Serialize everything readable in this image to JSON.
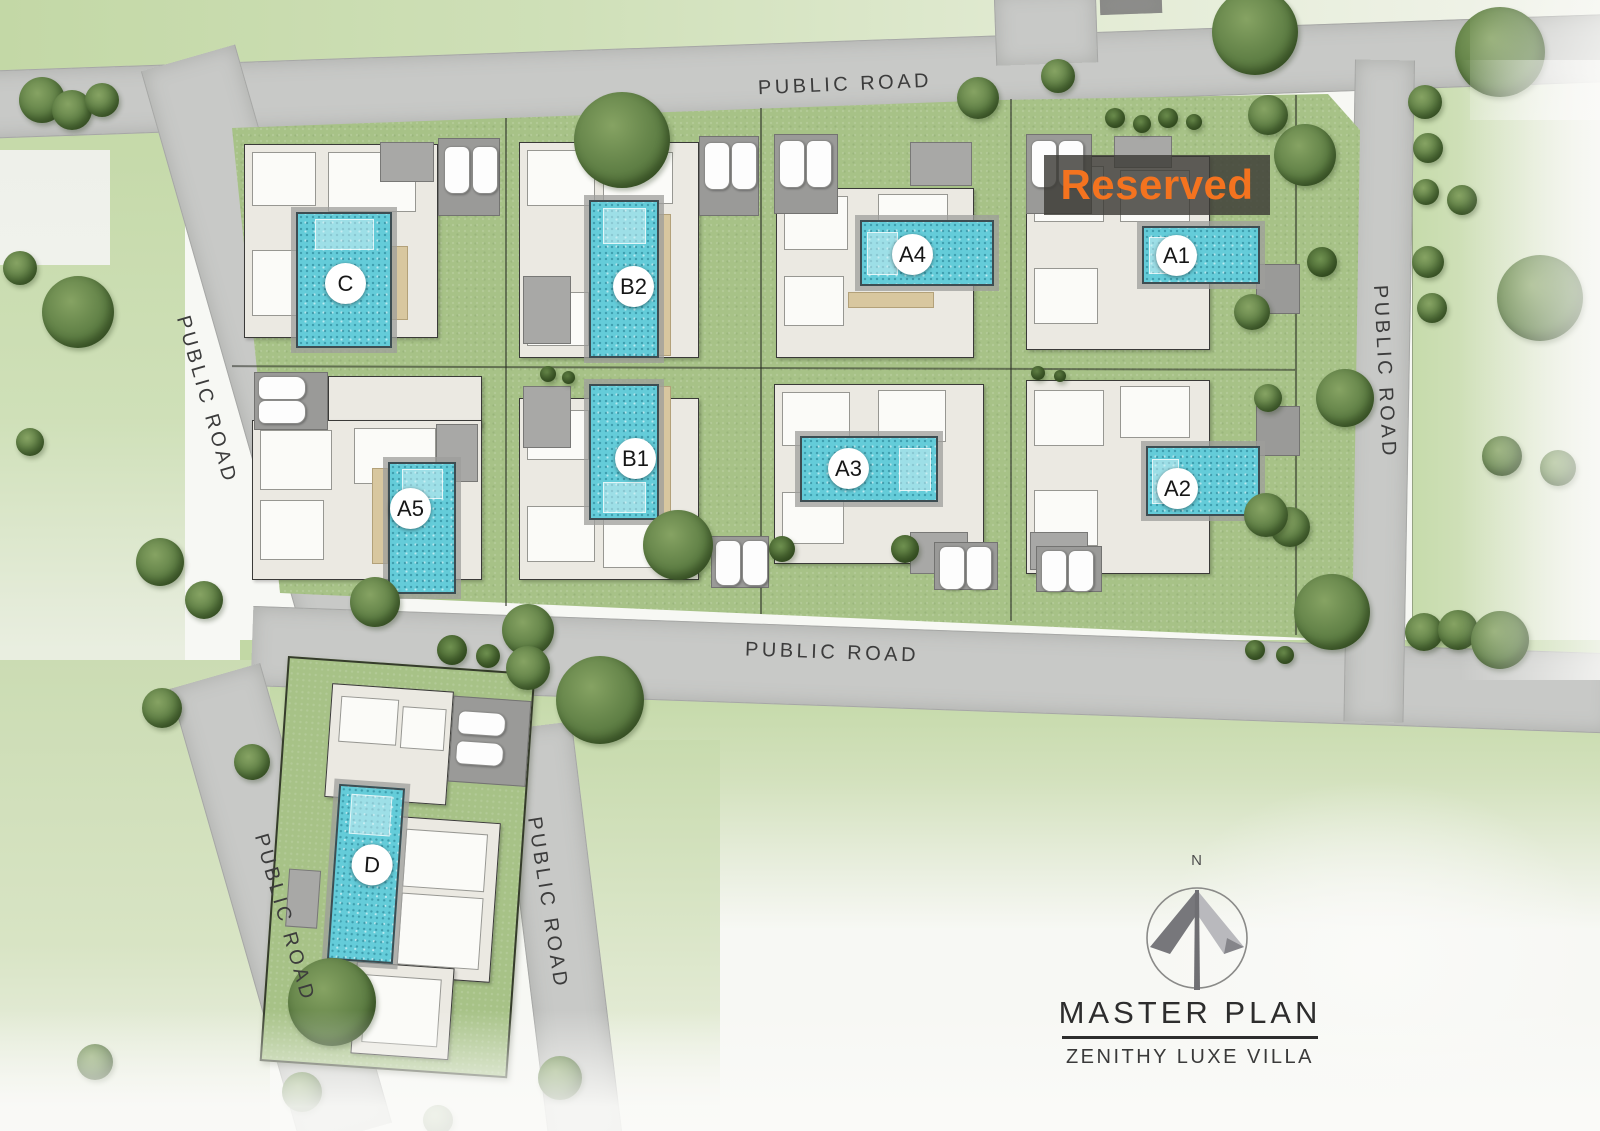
{
  "title": {
    "heading": "MASTER PLAN",
    "subtitle": "ZENITHY LUXE VILLA"
  },
  "compass": {
    "north_label": "N"
  },
  "reserved": {
    "label": "Reserved",
    "text_color": "#f4731f",
    "applies_to_villa": "A1"
  },
  "colors": {
    "road": "#c8c9c7",
    "lawn": "#cfe0b8",
    "compound_green": "#a7c287",
    "pool_water": "#64ccd9",
    "reserved_bg": "rgba(60,58,54,0.82)"
  },
  "roads": [
    {
      "id": "top",
      "label": "PUBLIC ROAD",
      "geom": {
        "x": -40,
        "y": 42,
        "w": 1700,
        "h": 66,
        "rot": -2,
        "org": "50% 50%",
        "cls": "hr"
      },
      "label_pos": {
        "x": 845,
        "y": 85,
        "rot": -2.5
      }
    },
    {
      "id": "top-stub",
      "label": null,
      "geom": {
        "x": 995,
        "y": -8,
        "w": 100,
        "h": 72,
        "rot": -2,
        "org": "50% 50%",
        "cls": "vr"
      },
      "label_pos": null
    },
    {
      "id": "left",
      "label": "PUBLIC ROAD",
      "geom": {
        "x": 139,
        "y": 58,
        "w": 96,
        "h": 600,
        "rot": -16,
        "org": "50% 0",
        "cls": "vr"
      },
      "label_pos": {
        "x": 206,
        "y": 400,
        "rot": 74
      }
    },
    {
      "id": "middle",
      "label": "PUBLIC ROAD",
      "geom": {
        "x": 252,
        "y": 606,
        "w": 1360,
        "h": 78,
        "rot": 2,
        "org": "0 50%",
        "cls": "hr"
      },
      "label_pos": {
        "x": 832,
        "y": 653,
        "rot": 2
      }
    },
    {
      "id": "right",
      "label": "PUBLIC ROAD",
      "geom": {
        "x": 1355,
        "y": 60,
        "w": 58,
        "h": 662,
        "rot": 1,
        "org": "50% 0",
        "cls": "vr"
      },
      "label_pos": {
        "x": 1384,
        "y": 372,
        "rot": 87
      }
    },
    {
      "id": "d-left",
      "label": "PUBLIC ROAD",
      "geom": {
        "x": 168,
        "y": 676,
        "w": 92,
        "h": 478,
        "rot": -16,
        "org": "50% 0",
        "cls": "vr"
      },
      "label_pos": {
        "x": 284,
        "y": 918,
        "rot": 74
      }
    },
    {
      "id": "d-right",
      "label": "PUBLIC ROAD",
      "geom": {
        "x": 498,
        "y": 726,
        "w": 72,
        "h": 420,
        "rot": -7,
        "org": "50% 0",
        "cls": "vr"
      },
      "label_pos": {
        "x": 547,
        "y": 903,
        "rot": 81
      }
    }
  ],
  "villas": [
    {
      "id": "C",
      "label": "C",
      "plot": {
        "x": 232,
        "y": 128,
        "w": 273,
        "h": 232,
        "rot": 0
      },
      "parts": [
        {
          "t": "bld",
          "x": 12,
          "y": 16,
          "w": 192,
          "h": 192
        },
        {
          "t": "room",
          "x": 20,
          "y": 24,
          "w": 62,
          "h": 52
        },
        {
          "t": "room",
          "x": 96,
          "y": 24,
          "w": 86,
          "h": 58
        },
        {
          "t": "room",
          "x": 20,
          "y": 122,
          "w": 58,
          "h": 64
        },
        {
          "t": "roof",
          "x": 148,
          "y": 14,
          "w": 52,
          "h": 38
        },
        {
          "t": "deck",
          "x": 158,
          "y": 118,
          "w": 16,
          "h": 72
        },
        {
          "t": "pad",
          "x": 206,
          "y": 10,
          "w": 60,
          "h": 76
        }
      ],
      "pool": {
        "x": 64,
        "y": 84,
        "w": 92,
        "h": 132,
        "step": "top"
      },
      "cars": [
        {
          "x": 212,
          "y": 18,
          "o": "v"
        },
        {
          "x": 240,
          "y": 18,
          "o": "v"
        }
      ],
      "label_pos": {
        "x": 113,
        "y": 155
      }
    },
    {
      "id": "A5",
      "label": "A5",
      "plot": {
        "x": 232,
        "y": 360,
        "w": 273,
        "h": 232,
        "rot": 0
      },
      "parts": [
        {
          "t": "bld",
          "x": 96,
          "y": 16,
          "w": 152,
          "h": 50
        },
        {
          "t": "bld",
          "x": 20,
          "y": 60,
          "w": 228,
          "h": 158
        },
        {
          "t": "room",
          "x": 28,
          "y": 70,
          "w": 70,
          "h": 58
        },
        {
          "t": "room",
          "x": 122,
          "y": 68,
          "w": 80,
          "h": 54
        },
        {
          "t": "room",
          "x": 28,
          "y": 140,
          "w": 62,
          "h": 58
        },
        {
          "t": "roof",
          "x": 204,
          "y": 64,
          "w": 40,
          "h": 56
        },
        {
          "t": "deck",
          "x": 140,
          "y": 108,
          "w": 14,
          "h": 94
        },
        {
          "t": "pad",
          "x": 22,
          "y": 12,
          "w": 72,
          "h": 56
        }
      ],
      "pool": {
        "x": 156,
        "y": 102,
        "w": 64,
        "h": 128,
        "step": "top"
      },
      "cars": [
        {
          "x": 26,
          "y": 16,
          "o": "h"
        },
        {
          "x": 26,
          "y": 40,
          "o": "h"
        }
      ],
      "label_pos": {
        "x": 178,
        "y": 148
      }
    },
    {
      "id": "B2",
      "label": "B2",
      "plot": {
        "x": 505,
        "y": 128,
        "w": 255,
        "h": 242,
        "rot": 0
      },
      "parts": [
        {
          "t": "bld",
          "x": 14,
          "y": 14,
          "w": 178,
          "h": 214
        },
        {
          "t": "room",
          "x": 22,
          "y": 22,
          "w": 66,
          "h": 54
        },
        {
          "t": "room",
          "x": 98,
          "y": 24,
          "w": 68,
          "h": 50
        },
        {
          "t": "room",
          "x": 22,
          "y": 164,
          "w": 60,
          "h": 52
        },
        {
          "t": "roof",
          "x": 18,
          "y": 148,
          "w": 46,
          "h": 66
        },
        {
          "t": "deck",
          "x": 152,
          "y": 86,
          "w": 12,
          "h": 140
        },
        {
          "t": "pad",
          "x": 194,
          "y": 8,
          "w": 58,
          "h": 78
        }
      ],
      "pool": {
        "x": 84,
        "y": 72,
        "w": 66,
        "h": 154,
        "step": "top"
      },
      "cars": [
        {
          "x": 199,
          "y": 14,
          "o": "v"
        },
        {
          "x": 226,
          "y": 14,
          "o": "v"
        }
      ],
      "label_pos": {
        "x": 128,
        "y": 158
      }
    },
    {
      "id": "B1",
      "label": "B1",
      "plot": {
        "x": 505,
        "y": 370,
        "w": 255,
        "h": 222,
        "rot": 0
      },
      "parts": [
        {
          "t": "bld",
          "x": 14,
          "y": 28,
          "w": 178,
          "h": 180
        },
        {
          "t": "room",
          "x": 22,
          "y": 136,
          "w": 66,
          "h": 54
        },
        {
          "t": "room",
          "x": 98,
          "y": 146,
          "w": 68,
          "h": 50
        },
        {
          "t": "room",
          "x": 22,
          "y": 40,
          "w": 60,
          "h": 48
        },
        {
          "t": "roof",
          "x": 18,
          "y": 16,
          "w": 46,
          "h": 60
        },
        {
          "t": "deck",
          "x": 152,
          "y": 16,
          "w": 12,
          "h": 130
        },
        {
          "t": "pad",
          "x": 206,
          "y": 166,
          "w": 56,
          "h": 50
        }
      ],
      "pool": {
        "x": 84,
        "y": 14,
        "w": 66,
        "h": 132,
        "step": "bottom"
      },
      "cars": [
        {
          "x": 210,
          "y": 170,
          "o": "v",
          "len": 44
        },
        {
          "x": 237,
          "y": 170,
          "o": "v",
          "len": 44
        }
      ],
      "label_pos": {
        "x": 130,
        "y": 88
      }
    },
    {
      "id": "A4",
      "label": "A4",
      "plot": {
        "x": 760,
        "y": 128,
        "w": 250,
        "h": 244,
        "rot": 0
      },
      "parts": [
        {
          "t": "bld",
          "x": 16,
          "y": 60,
          "w": 196,
          "h": 168
        },
        {
          "t": "room",
          "x": 24,
          "y": 68,
          "w": 62,
          "h": 52
        },
        {
          "t": "room",
          "x": 118,
          "y": 66,
          "w": 68,
          "h": 54
        },
        {
          "t": "room",
          "x": 24,
          "y": 148,
          "w": 58,
          "h": 48
        },
        {
          "t": "roof",
          "x": 150,
          "y": 14,
          "w": 60,
          "h": 42
        },
        {
          "t": "deck",
          "x": 88,
          "y": 164,
          "w": 84,
          "h": 14
        },
        {
          "t": "pad",
          "x": 14,
          "y": 6,
          "w": 62,
          "h": 78
        }
      ],
      "pool": {
        "x": 100,
        "y": 92,
        "w": 130,
        "h": 62,
        "step": "left"
      },
      "cars": [
        {
          "x": 19,
          "y": 12,
          "o": "v"
        },
        {
          "x": 46,
          "y": 12,
          "o": "v"
        }
      ],
      "label_pos": {
        "x": 152,
        "y": 126
      }
    },
    {
      "id": "A3",
      "label": "A3",
      "plot": {
        "x": 760,
        "y": 372,
        "w": 250,
        "h": 220,
        "rot": 0
      },
      "parts": [
        {
          "t": "bld",
          "x": 14,
          "y": 12,
          "w": 208,
          "h": 178
        },
        {
          "t": "room",
          "x": 22,
          "y": 20,
          "w": 66,
          "h": 52
        },
        {
          "t": "room",
          "x": 118,
          "y": 18,
          "w": 66,
          "h": 50
        },
        {
          "t": "room",
          "x": 22,
          "y": 120,
          "w": 60,
          "h": 50
        },
        {
          "t": "roof",
          "x": 150,
          "y": 160,
          "w": 56,
          "h": 40
        },
        {
          "t": "pad",
          "x": 174,
          "y": 170,
          "w": 62,
          "h": 46
        }
      ],
      "pool": {
        "x": 40,
        "y": 64,
        "w": 134,
        "h": 62,
        "step": "right"
      },
      "cars": [
        {
          "x": 179,
          "y": 174,
          "o": "v",
          "len": 42
        },
        {
          "x": 206,
          "y": 174,
          "o": "v",
          "len": 42
        }
      ],
      "label_pos": {
        "x": 88,
        "y": 96
      }
    },
    {
      "id": "A1",
      "label": "A1",
      "plot": {
        "x": 1010,
        "y": 128,
        "w": 285,
        "h": 244,
        "rot": 0
      },
      "parts": [
        {
          "t": "bld",
          "x": 16,
          "y": 28,
          "w": 182,
          "h": 192
        },
        {
          "t": "room",
          "x": 24,
          "y": 38,
          "w": 68,
          "h": 54
        },
        {
          "t": "room",
          "x": 110,
          "y": 42,
          "w": 68,
          "h": 50
        },
        {
          "t": "room",
          "x": 24,
          "y": 140,
          "w": 62,
          "h": 54
        },
        {
          "t": "roof",
          "x": 104,
          "y": 8,
          "w": 56,
          "h": 30
        },
        {
          "t": "pad",
          "x": 16,
          "y": 6,
          "w": 64,
          "h": 78
        },
        {
          "t": "pad",
          "x": 246,
          "y": 136,
          "w": 42,
          "h": 48
        }
      ],
      "pool": {
        "x": 132,
        "y": 98,
        "w": 114,
        "h": 54,
        "step": "left"
      },
      "cars": [
        {
          "x": 21,
          "y": 12,
          "o": "v"
        },
        {
          "x": 48,
          "y": 12,
          "o": "v"
        }
      ],
      "label_pos": {
        "x": 166,
        "y": 127
      }
    },
    {
      "id": "A2",
      "label": "A2",
      "plot": {
        "x": 1010,
        "y": 372,
        "w": 285,
        "h": 220,
        "rot": 0
      },
      "parts": [
        {
          "t": "bld",
          "x": 16,
          "y": 8,
          "w": 182,
          "h": 192
        },
        {
          "t": "room",
          "x": 24,
          "y": 18,
          "w": 68,
          "h": 54
        },
        {
          "t": "room",
          "x": 110,
          "y": 14,
          "w": 68,
          "h": 50
        },
        {
          "t": "room",
          "x": 24,
          "y": 118,
          "w": 62,
          "h": 54
        },
        {
          "t": "roof",
          "x": 20,
          "y": 160,
          "w": 56,
          "h": 36
        },
        {
          "t": "pad",
          "x": 26,
          "y": 174,
          "w": 64,
          "h": 44
        },
        {
          "t": "pad",
          "x": 246,
          "y": 34,
          "w": 42,
          "h": 48
        }
      ],
      "pool": {
        "x": 136,
        "y": 74,
        "w": 110,
        "h": 66,
        "step": "left"
      },
      "cars": [
        {
          "x": 31,
          "y": 178,
          "o": "v",
          "len": 40
        },
        {
          "x": 58,
          "y": 178,
          "o": "v",
          "len": 40
        }
      ],
      "label_pos": {
        "x": 167,
        "y": 116
      }
    },
    {
      "id": "D",
      "label": "D",
      "plot": {
        "x": 288,
        "y": 656,
        "w": 244,
        "h": 402,
        "rot": 4,
        "standalone": true
      },
      "parts": [
        {
          "t": "bld",
          "x": 44,
          "y": 22,
          "w": 120,
          "h": 112
        },
        {
          "t": "room",
          "x": 54,
          "y": 34,
          "w": 56,
          "h": 44
        },
        {
          "t": "room",
          "x": 116,
          "y": 40,
          "w": 42,
          "h": 40
        },
        {
          "t": "pad",
          "x": 166,
          "y": 26,
          "w": 76,
          "h": 84
        },
        {
          "t": "bld",
          "x": 118,
          "y": 150,
          "w": 102,
          "h": 158
        },
        {
          "t": "room",
          "x": 128,
          "y": 162,
          "w": 80,
          "h": 56
        },
        {
          "t": "room",
          "x": 128,
          "y": 226,
          "w": 80,
          "h": 70
        },
        {
          "t": "bld",
          "x": 88,
          "y": 298,
          "w": 96,
          "h": 90
        },
        {
          "t": "room",
          "x": 98,
          "y": 310,
          "w": 74,
          "h": 66
        },
        {
          "t": "roof",
          "x": 14,
          "y": 210,
          "w": 30,
          "h": 56
        },
        {
          "t": "deck",
          "x": 40,
          "y": 328,
          "w": 60,
          "h": 16
        }
      ],
      "pool": {
        "x": 58,
        "y": 122,
        "w": 62,
        "h": 172,
        "step": "top"
      },
      "cars": [
        {
          "x": 172,
          "y": 40,
          "o": "h"
        },
        {
          "x": 172,
          "y": 70,
          "o": "h"
        }
      ],
      "label_pos": {
        "x": 96,
        "y": 200
      }
    },
    {
      "id": "right-lawn",
      "label": null,
      "plot": {
        "x": 1295,
        "y": 96,
        "w": 60,
        "h": 540,
        "rot": 0
      },
      "parts": [],
      "pool": null,
      "cars": [],
      "label_pos": null
    }
  ],
  "trees": [
    {
      "x": 622,
      "y": 140,
      "d": 96
    },
    {
      "x": 978,
      "y": 98,
      "d": 42
    },
    {
      "x": 1058,
      "y": 76,
      "d": 34
    },
    {
      "x": 1255,
      "y": 32,
      "d": 86
    },
    {
      "x": 1115,
      "y": 118,
      "d": 20,
      "p": 1
    },
    {
      "x": 1142,
      "y": 124,
      "d": 18,
      "p": 1
    },
    {
      "x": 1168,
      "y": 118,
      "d": 20,
      "p": 1
    },
    {
      "x": 1194,
      "y": 122,
      "d": 16,
      "p": 1
    },
    {
      "x": 42,
      "y": 100,
      "d": 46
    },
    {
      "x": 72,
      "y": 110,
      "d": 40
    },
    {
      "x": 102,
      "y": 100,
      "d": 34
    },
    {
      "x": 78,
      "y": 312,
      "d": 72
    },
    {
      "x": 20,
      "y": 268,
      "d": 34
    },
    {
      "x": 30,
      "y": 442,
      "d": 28
    },
    {
      "x": 160,
      "y": 562,
      "d": 48
    },
    {
      "x": 204,
      "y": 600,
      "d": 38
    },
    {
      "x": 1500,
      "y": 52,
      "d": 90
    },
    {
      "x": 1540,
      "y": 298,
      "d": 86
    },
    {
      "x": 1425,
      "y": 102,
      "d": 34
    },
    {
      "x": 1428,
      "y": 148,
      "d": 30
    },
    {
      "x": 1426,
      "y": 192,
      "d": 26
    },
    {
      "x": 1462,
      "y": 200,
      "d": 30
    },
    {
      "x": 1428,
      "y": 262,
      "d": 32
    },
    {
      "x": 1432,
      "y": 308,
      "d": 30
    },
    {
      "x": 1502,
      "y": 456,
      "d": 40
    },
    {
      "x": 1558,
      "y": 468,
      "d": 36
    },
    {
      "x": 1424,
      "y": 632,
      "d": 38
    },
    {
      "x": 1458,
      "y": 630,
      "d": 40
    },
    {
      "x": 1500,
      "y": 640,
      "d": 58
    },
    {
      "x": 1305,
      "y": 155,
      "d": 62
    },
    {
      "x": 1268,
      "y": 115,
      "d": 40
    },
    {
      "x": 1322,
      "y": 262,
      "d": 30,
      "p": 1
    },
    {
      "x": 1345,
      "y": 398,
      "d": 58
    },
    {
      "x": 1290,
      "y": 527,
      "d": 40
    },
    {
      "x": 1332,
      "y": 612,
      "d": 76
    },
    {
      "x": 1255,
      "y": 650,
      "d": 20,
      "p": 1
    },
    {
      "x": 1285,
      "y": 655,
      "d": 18,
      "p": 1
    },
    {
      "x": 1266,
      "y": 515,
      "d": 44
    },
    {
      "x": 1252,
      "y": 312,
      "d": 36
    },
    {
      "x": 1268,
      "y": 398,
      "d": 28
    },
    {
      "x": 678,
      "y": 545,
      "d": 70
    },
    {
      "x": 782,
      "y": 549,
      "d": 26,
      "p": 1
    },
    {
      "x": 905,
      "y": 549,
      "d": 28,
      "p": 1
    },
    {
      "x": 548,
      "y": 374,
      "d": 16,
      "p": 1
    },
    {
      "x": 568,
      "y": 377,
      "d": 13,
      "p": 1
    },
    {
      "x": 1038,
      "y": 373,
      "d": 14,
      "p": 1
    },
    {
      "x": 1060,
      "y": 376,
      "d": 12,
      "p": 1
    },
    {
      "x": 600,
      "y": 700,
      "d": 88
    },
    {
      "x": 528,
      "y": 630,
      "d": 52
    },
    {
      "x": 528,
      "y": 668,
      "d": 44
    },
    {
      "x": 375,
      "y": 602,
      "d": 50
    },
    {
      "x": 452,
      "y": 650,
      "d": 30,
      "p": 1
    },
    {
      "x": 488,
      "y": 656,
      "d": 24,
      "p": 1
    },
    {
      "x": 332,
      "y": 1002,
      "d": 88
    },
    {
      "x": 252,
      "y": 762,
      "d": 36
    },
    {
      "x": 560,
      "y": 1078,
      "d": 44
    },
    {
      "x": 302,
      "y": 1092,
      "d": 40
    },
    {
      "x": 162,
      "y": 708,
      "d": 40
    },
    {
      "x": 95,
      "y": 1062,
      "d": 36
    },
    {
      "x": 438,
      "y": 1120,
      "d": 30
    }
  ]
}
